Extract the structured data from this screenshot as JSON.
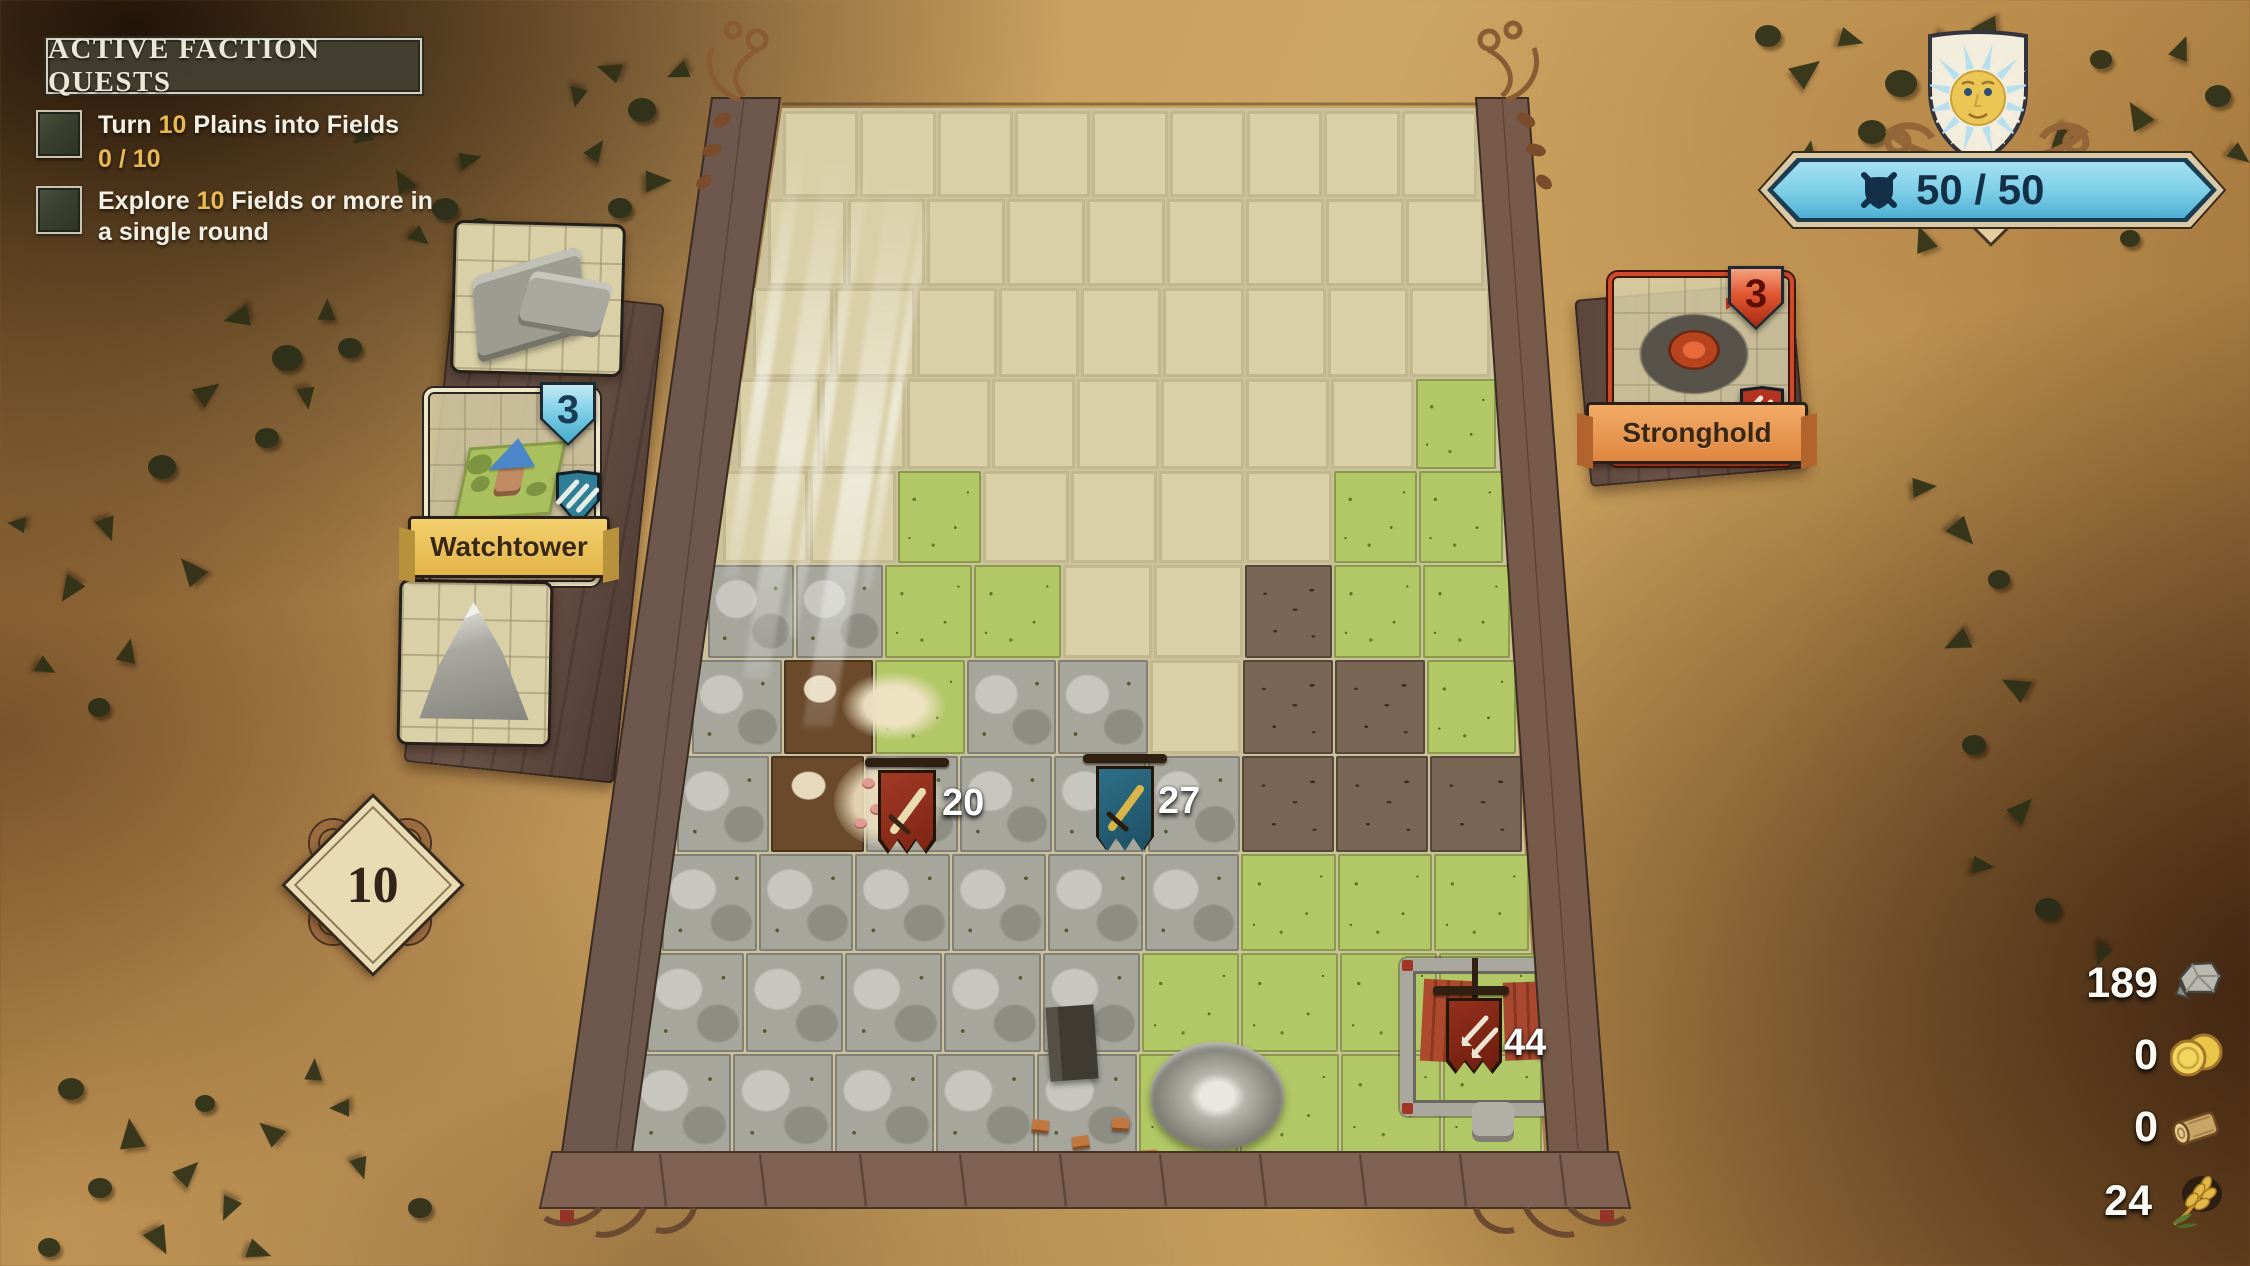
{
  "quest_panel": {
    "title": "ACTIVE FACTION QUESTS",
    "quests": [
      {
        "prefix": "Turn ",
        "amount": "10",
        "suffix": " Plains into Fields",
        "progress": "0 / 10"
      },
      {
        "prefix": "Explore ",
        "amount": "10",
        "suffix": " Fields or more in a single round",
        "progress": ""
      }
    ]
  },
  "build_panel": {
    "cards": [
      {
        "label": "",
        "count": "",
        "type": "wall-corner-tile"
      },
      {
        "label": "Watchtower",
        "count": "3",
        "type": "watchtower-tile"
      },
      {
        "label": "",
        "count": "",
        "type": "mountain-tile"
      }
    ],
    "round_indicator": "10"
  },
  "stronghold_card": {
    "label": "Stronghold",
    "count": "3"
  },
  "morale": {
    "value": "50 / 50"
  },
  "resources": [
    {
      "name": "stone",
      "value": "189"
    },
    {
      "name": "gold",
      "value": "0"
    },
    {
      "name": "wood",
      "value": "0"
    },
    {
      "name": "wheat",
      "value": "24"
    }
  ],
  "map_markers": [
    {
      "name": "red-army",
      "value": "20"
    },
    {
      "name": "blue-army",
      "value": "27"
    },
    {
      "name": "fort-garrison",
      "value": "44"
    }
  ],
  "board": {
    "columns": 9,
    "rows": 11,
    "tile_map": [
      "UUUUUUUUU",
      "UUUUUUUUU",
      "UUUUUUUUU",
      "UUUUUUUUG",
      "UUGUUUUGG",
      "RRGGUUBGG",
      "RMGRRUBBG",
      "RMRRRRBBB",
      "RRRRRRGGG",
      "RRRRRGGFG",
      "RRRRRGGGG"
    ],
    "terrain_legend": {
      "U": "unexplored",
      "G": "field",
      "R": "rock",
      "B": "badlands",
      "M": "mud",
      "F": "field-fort"
    }
  },
  "colors": {
    "parchment": "#c79b5b",
    "quest_gold": "#e7b94e",
    "morale_banner": "#7fd0e8",
    "watchtower_accent": "#5fb8d8",
    "stronghold_accent": "#cd4b2b",
    "banner_yellow": "#ecc55c",
    "banner_orange": "#eb9a52",
    "unexplored_tile": "#d9d0a8",
    "field_tile": "#b2c766",
    "rock_tile": "#a6a69d"
  }
}
